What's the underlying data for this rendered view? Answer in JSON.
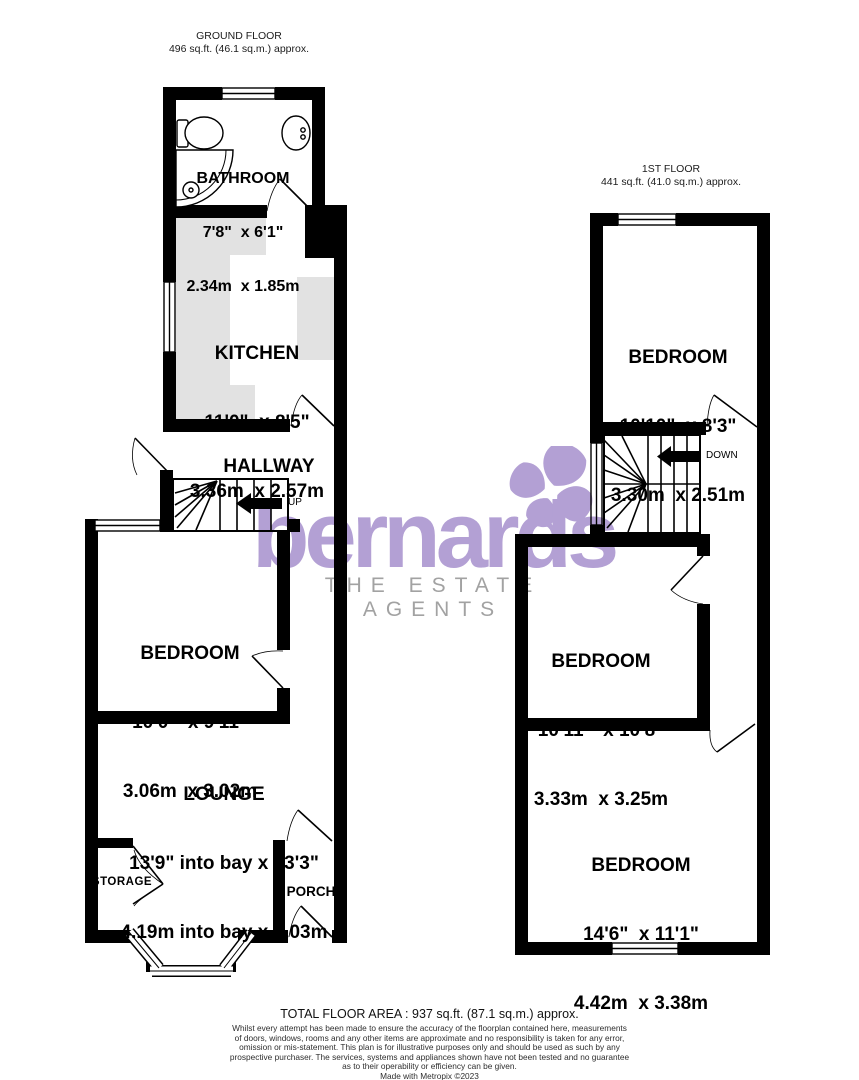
{
  "ground_floor": {
    "header": {
      "title": "GROUND FLOOR",
      "area": "496 sq.ft. (46.1 sq.m.) approx."
    },
    "rooms": {
      "bathroom": {
        "name": "BATHROOM",
        "imperial": "7'8\"  x 6'1\"",
        "metric": "2.34m  x 1.85m"
      },
      "kitchen": {
        "name": "KITCHEN",
        "imperial": "11'0\"  x 8'5\"",
        "metric": "3.36m  x 2.57m"
      },
      "bedroom": {
        "name": "BEDROOM",
        "imperial": "10'0\"  x 9'11\"",
        "metric": "3.06m  x 3.02m"
      },
      "lounge": {
        "name": "LOUNGE",
        "imperial": "13'9\" into bay x 13'3\"",
        "metric": "4.19m into bay x 4.03m"
      }
    },
    "labels": {
      "hallway": "HALLWAY",
      "storage": "STORAGE",
      "porch": "PORCH",
      "up": "UP"
    }
  },
  "first_floor": {
    "header": {
      "title": "1ST FLOOR",
      "area": "441 sq.ft. (41.0 sq.m.) approx."
    },
    "rooms": {
      "bedroom_top": {
        "name": "BEDROOM",
        "imperial": "10'10\"  x 8'3\"",
        "metric": "3.30m  x 2.51m"
      },
      "bedroom_middle": {
        "name": "BEDROOM",
        "imperial": "10'11\"  x 10'8\"",
        "metric": "3.33m  x 3.25m"
      },
      "bedroom_bottom": {
        "name": "BEDROOM",
        "imperial": "14'6\"  x 11'1\"",
        "metric": "4.42m  x 3.38m"
      }
    },
    "labels": {
      "down": "DOWN"
    }
  },
  "watermark": {
    "brand": "bernards",
    "tagline": "THE ESTATE AGENTS",
    "purple": "#b3a0d4",
    "gray": "#a2a2a2"
  },
  "footer": {
    "total_area": "TOTAL FLOOR AREA : 937 sq.ft. (87.1 sq.m.) approx.",
    "disclaimer_lines": [
      "Whilst every attempt has been made to ensure the accuracy of the floorplan contained here, measurements",
      "of doors, windows, rooms and any other items are approximate and no responsibility is taken for any error,",
      "omission or mis-statement. This plan is for illustrative purposes only and should be used as such by any",
      "prospective purchaser. The services, systems and appliances shown have not been tested and no guarantee",
      "as to their operability or efficiency can be given."
    ],
    "credit": "Made with Metropix ©2023"
  }
}
